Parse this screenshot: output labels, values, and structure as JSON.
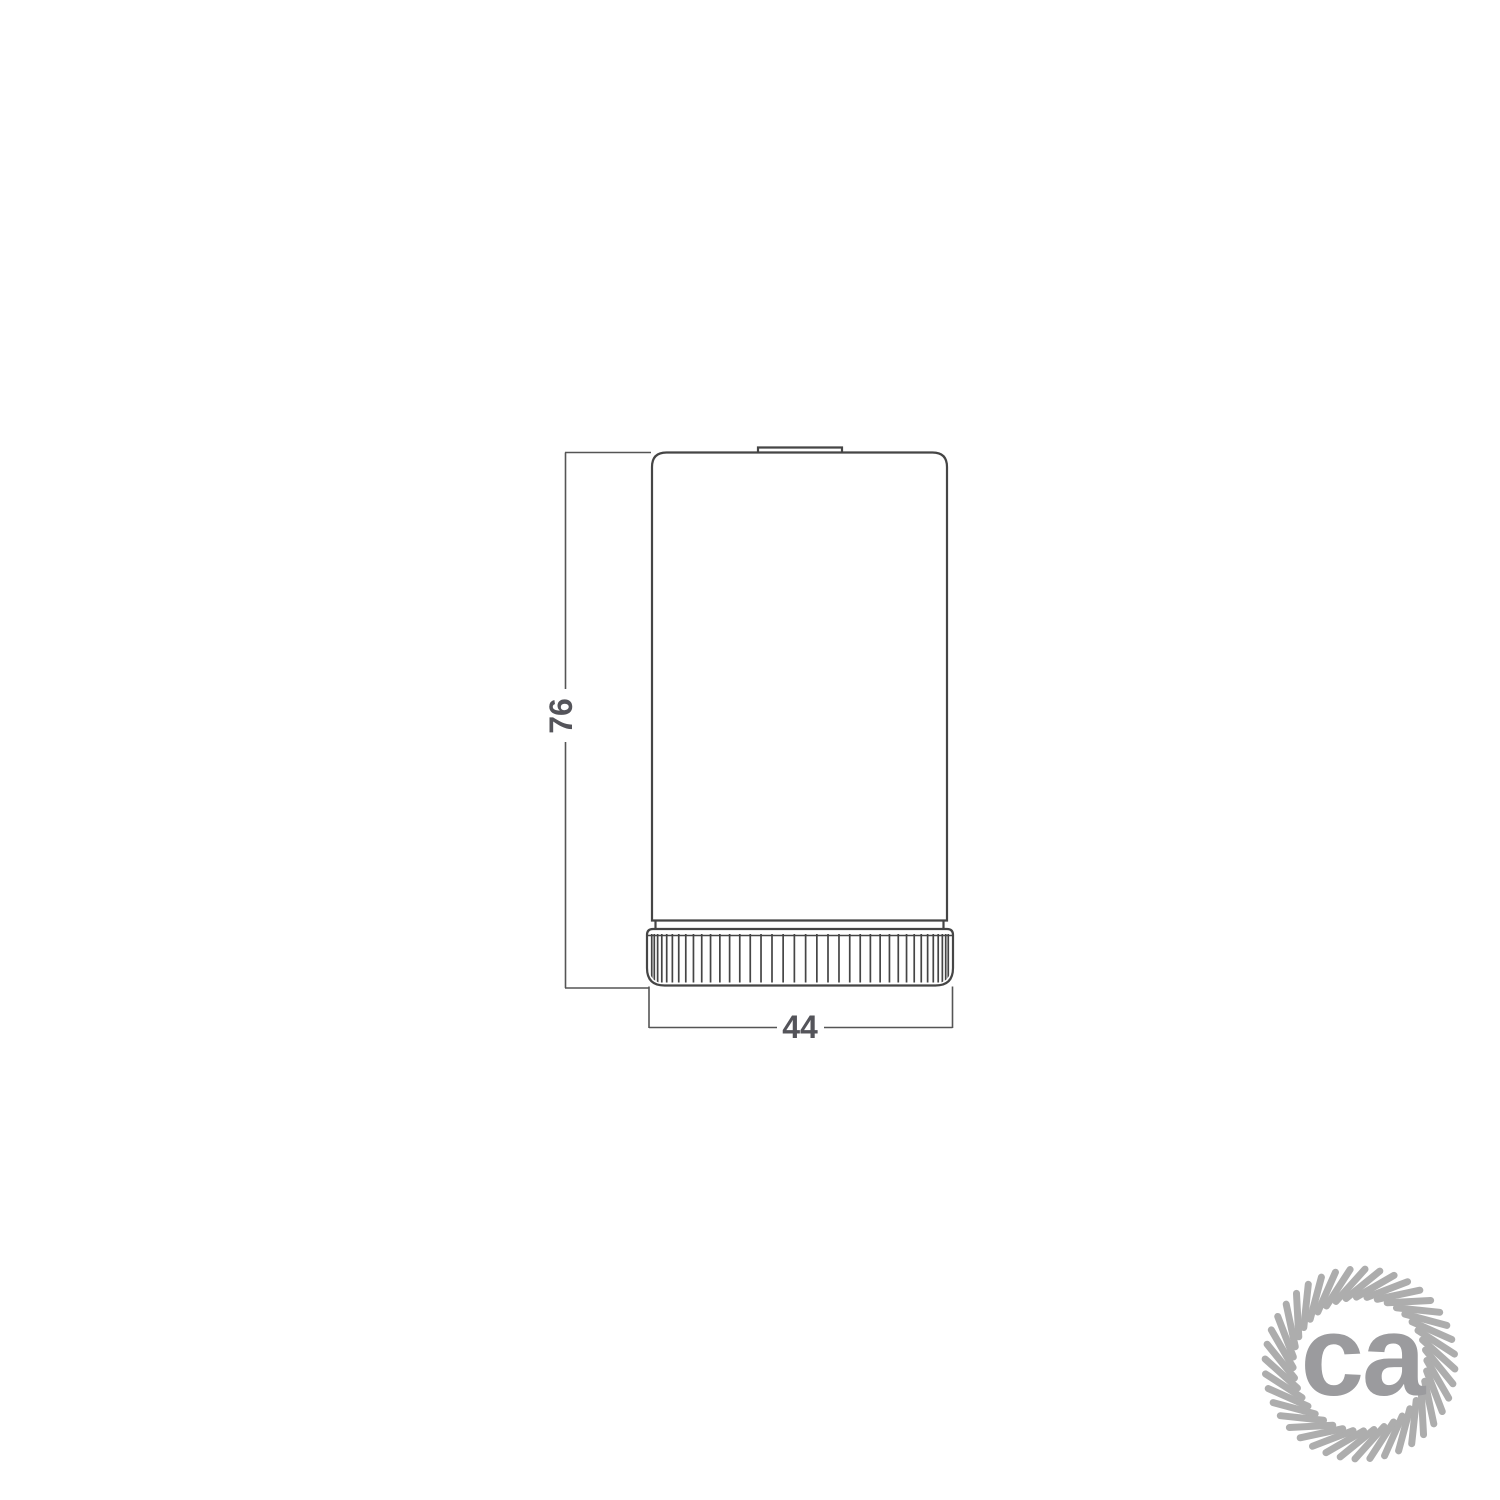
{
  "drawing": {
    "subject": "cylindrical-lampholder-side-view",
    "height_dimension": {
      "value": "76"
    },
    "width_dimension": {
      "value": "44"
    }
  },
  "logo": {
    "text": "ca"
  },
  "colors": {
    "background": "#ffffff",
    "outline": "#454545",
    "dimension_line": "#555555",
    "dimension_text": "#54545a",
    "logo_rope": "#adadad",
    "logo_text": "#9b9b9e"
  }
}
